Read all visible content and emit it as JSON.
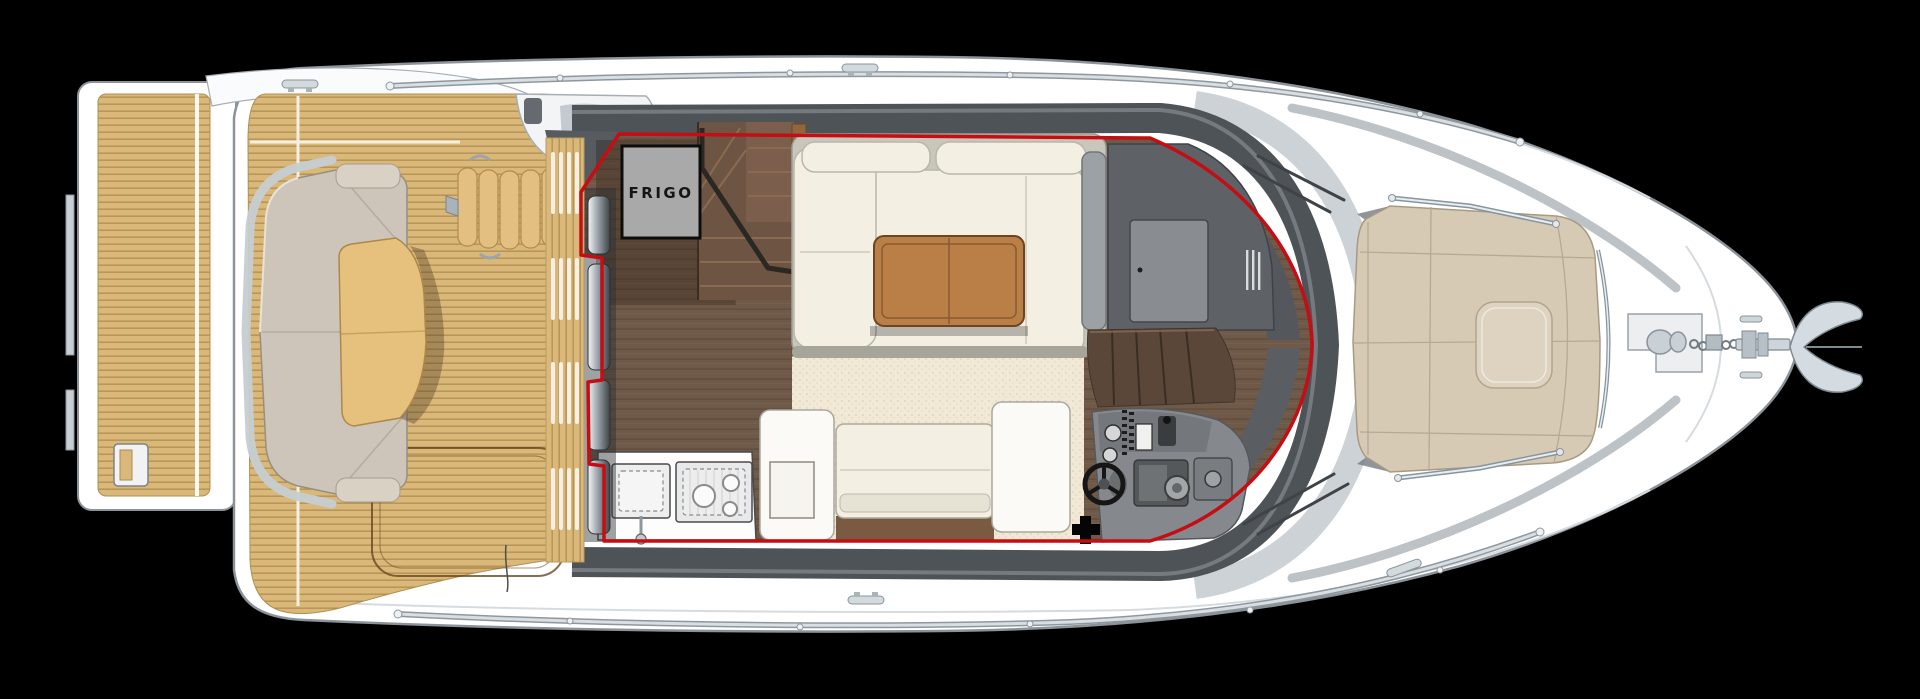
{
  "diagram": {
    "type": "yacht-deck-plan",
    "labels": {
      "fridge": "FRIGO"
    }
  },
  "colors": {
    "background": "#000000",
    "hull_white": "#ffffff",
    "deck_band_dark": "#4e5357",
    "windshield_silver": "#ccd2d6",
    "salon_outline_red": "#c50d13",
    "teak": "#d9b87a",
    "cockpit_cushion": "#cdc5ba",
    "cockpit_table": "#e6c07d",
    "salon_wood": "#6f5948",
    "carpet": "#f1e9d6",
    "sofa_white": "#f3efe3",
    "salon_table_wood": "#b97f46",
    "frigo_gray": "#a9a9aa",
    "cabinet_gray": "#5e6267",
    "stair_brown": "#6e5443",
    "sunpad_beige": "#d7cab5",
    "helm_gray": "#85898d",
    "anchor_metal": "#d4dce1"
  }
}
